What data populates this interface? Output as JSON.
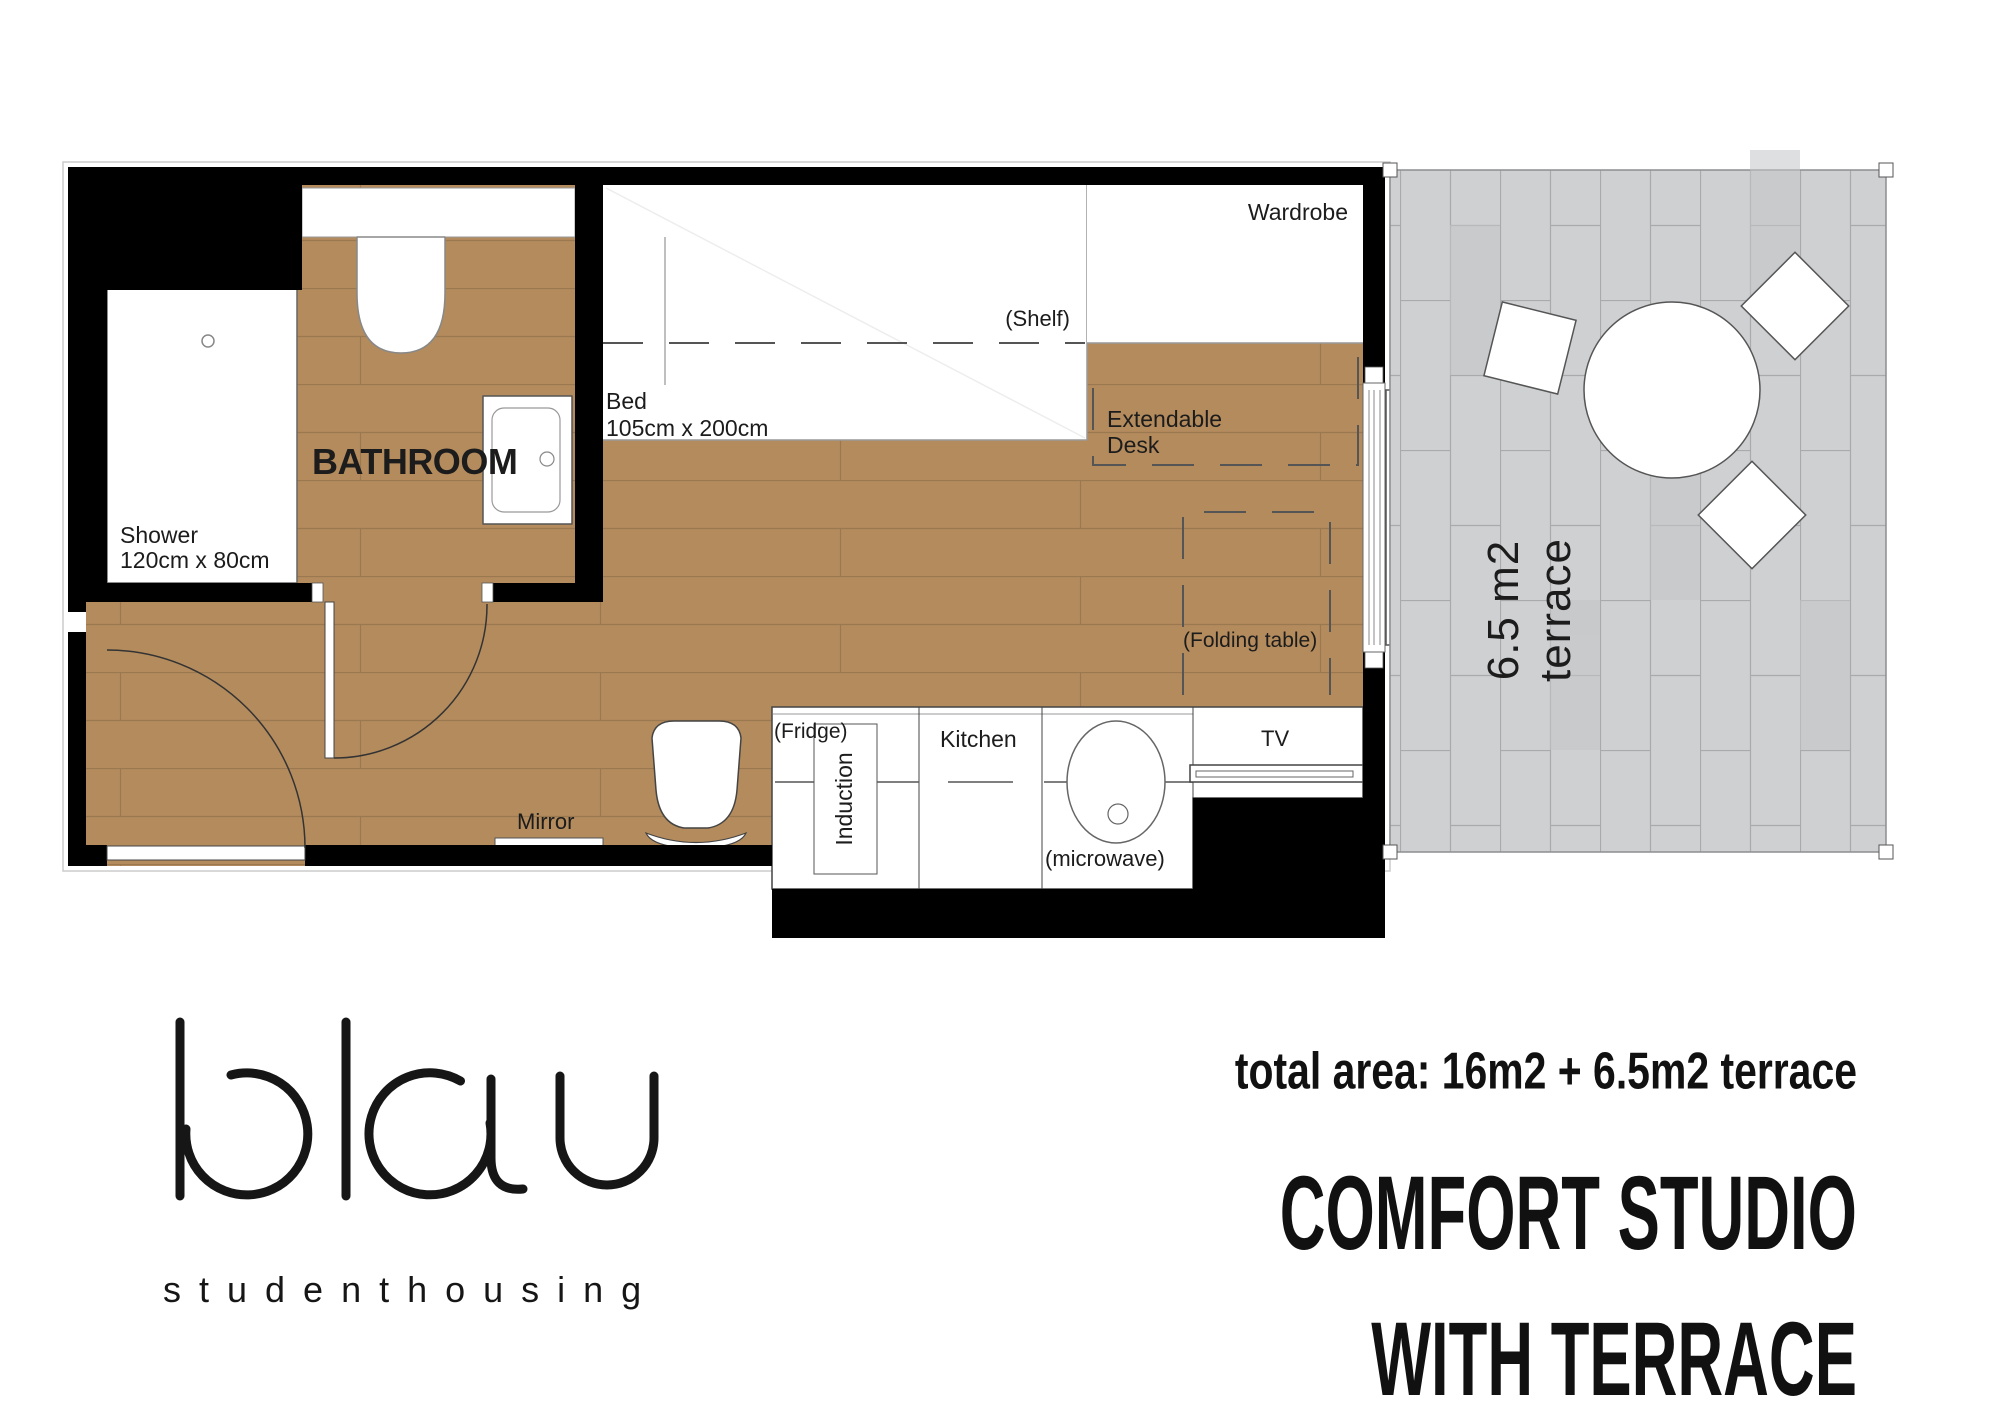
{
  "plan": {
    "labels": {
      "wardrobe": "Wardrobe",
      "shelf": "(Shelf)",
      "bed_name": "Bed",
      "bed_size": "105cm x 200cm",
      "extendable_desk": "Extendable Desk",
      "folding_table": "(Folding table)",
      "bathroom": "BATHROOM",
      "shower_name": "Shower",
      "shower_size": "120cm x 80cm",
      "mirror": "Mirror",
      "fridge": "(Fridge)",
      "induction": "Induction",
      "kitchen": "Kitchen",
      "microwave": "(microwave)",
      "tv": "TV"
    },
    "terrace": {
      "line1": "6.5 m2",
      "line2": "terrace"
    },
    "colors": {
      "floor": "#b48b5d",
      "floor_joint": "#9a7850",
      "terrace_tile": "#ced0d2",
      "terrace_joint": "#a8aaac",
      "wall": "#000000",
      "fixture_outline": "#555555"
    }
  },
  "branding": {
    "logo": "blau",
    "tagline": "studenthousing"
  },
  "summary": {
    "total_area": "total area: 16m2 + 6.5m2 terrace",
    "title_line1": "COMFORT STUDIO",
    "title_line2": "WITH TERRACE"
  }
}
